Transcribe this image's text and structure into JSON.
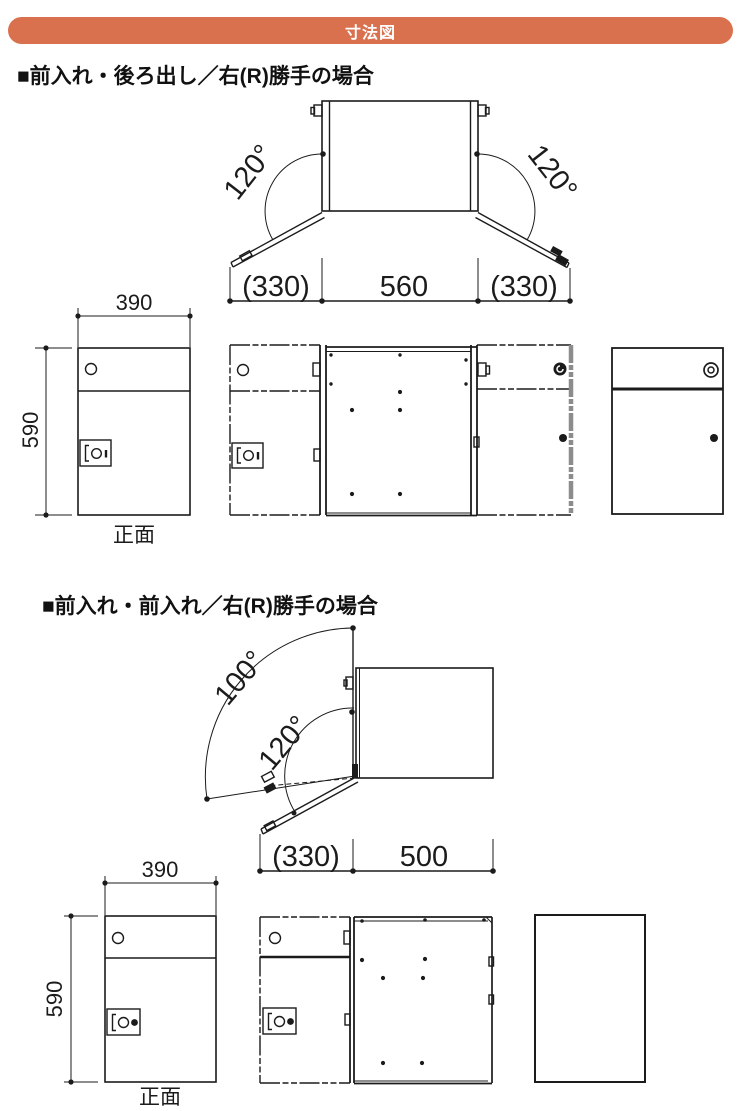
{
  "header": {
    "title": "寸法図"
  },
  "colors": {
    "accent_bar": "#d9714f",
    "line": "#1b1b1b"
  },
  "section1": {
    "title": "■前入れ・後ろ出し／右(R)勝手の場合",
    "top_view": {
      "angle_left": "120°",
      "angle_right": "120°",
      "dim_left": "(330)",
      "dim_center": "560",
      "dim_right": "(330)"
    },
    "front_view": {
      "width": "390",
      "height": "590",
      "caption": "正面"
    }
  },
  "section2": {
    "title": "■前入れ・前入れ／右(R)勝手の場合",
    "top_view": {
      "angle_outer": "100°",
      "angle_inner": "120°",
      "dim_left": "(330)",
      "dim_right": "500"
    },
    "front_view": {
      "width": "390",
      "height": "590",
      "caption": "正面"
    }
  }
}
